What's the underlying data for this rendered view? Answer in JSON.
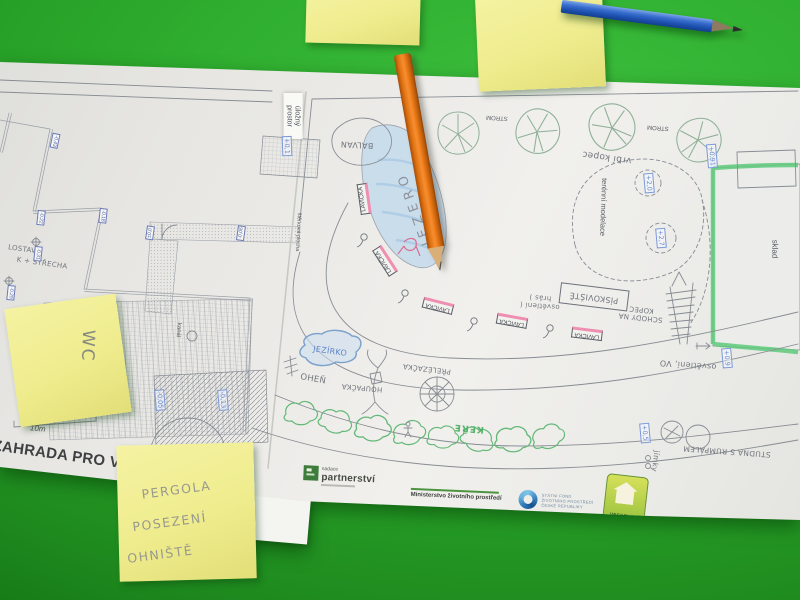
{
  "plan": {
    "title": "ZAHRADA PRO VŠEC",
    "scale": "10m",
    "labels": [
      {
        "text": "úložný prostor",
        "x": 293,
        "y": 116,
        "rot": 90,
        "cls": "tag",
        "fs": 7,
        "w": 40,
        "name": "label-ulozny-prostor"
      },
      {
        "text": "BALVAN",
        "x": 357,
        "y": 144,
        "rot": 183,
        "cls": "hand",
        "fs": 8,
        "name": "label-balvan"
      },
      {
        "text": "JEZERO",
        "x": 415,
        "y": 208,
        "rot": 250,
        "cls": "hand jez",
        "fs": 13,
        "name": "label-jezero"
      },
      {
        "text": "STROM",
        "x": 497,
        "y": 117,
        "rot": 183,
        "cls": "print",
        "fs": 6,
        "name": "label-strom"
      },
      {
        "text": "STROM",
        "x": 658,
        "y": 127,
        "rot": 184,
        "cls": "print",
        "fs": 6,
        "name": "label-strom"
      },
      {
        "text": "vrbí kopec",
        "x": 607,
        "y": 156,
        "rot": 188,
        "cls": "hand",
        "fs": 9,
        "name": "label-vrbi-kopec"
      },
      {
        "text": "terénní modelace",
        "x": 603,
        "y": 207,
        "rot": 92,
        "cls": "print",
        "fs": 7.5,
        "name": "label-terenni-modelace"
      },
      {
        "text": "sklad",
        "x": 774,
        "y": 249,
        "rot": 91,
        "cls": "print",
        "fs": 8,
        "name": "label-sklad"
      },
      {
        "text": "PÍSKOVIŠTĚ",
        "x": 594,
        "y": 297,
        "rot": 187,
        "cls": "hand box",
        "fs": 8,
        "name": "label-piskoviste"
      },
      {
        "text": "SCHODY NA KOPEC",
        "x": 641,
        "y": 313,
        "rot": 186,
        "cls": "hand",
        "fs": 7,
        "w": 46,
        "name": "label-schody-na-kopec"
      },
      {
        "text": "osvětlení ( hrás )",
        "x": 540,
        "y": 301,
        "rot": 184,
        "cls": "hand",
        "fs": 7,
        "w": 42,
        "name": "label-osvetleni"
      },
      {
        "text": "osvětlení, VO",
        "x": 688,
        "y": 364,
        "rot": 184,
        "cls": "hand",
        "fs": 8,
        "name": "label-osvetleni-vo"
      },
      {
        "text": "JEZÍRKO",
        "x": 330,
        "y": 352,
        "rot": 8,
        "cls": "hand blue",
        "fs": 8,
        "name": "label-jezirko"
      },
      {
        "text": "OHEŇ",
        "x": 313,
        "y": 380,
        "rot": 10,
        "cls": "hand",
        "fs": 8.5,
        "name": "label-ohen"
      },
      {
        "text": "HOUPAČKA",
        "x": 362,
        "y": 387,
        "rot": 185,
        "cls": "hand",
        "fs": 7,
        "name": "label-houpacka"
      },
      {
        "text": "PŘELÉZAČKA",
        "x": 427,
        "y": 368,
        "rot": 187,
        "cls": "hand",
        "fs": 7,
        "name": "label-prelezacka"
      },
      {
        "text": "KEŘE",
        "x": 469,
        "y": 427,
        "rot": 185,
        "cls": "hand green",
        "fs": 9,
        "name": "label-kere"
      },
      {
        "text": "STUDNA S RUMPÁLEM",
        "x": 727,
        "y": 451,
        "rot": 184,
        "cls": "hand",
        "fs": 7.5,
        "name": "label-studna"
      },
      {
        "text": "jímky",
        "x": 655,
        "y": 461,
        "rot": 97,
        "cls": "hand",
        "fs": 7.5,
        "name": "label-jimky"
      },
      {
        "text": "kanál",
        "x": 178,
        "y": 330,
        "rot": 95,
        "cls": "print",
        "fs": 6,
        "name": "label-kanal"
      },
      {
        "text": "bez",
        "x": 237,
        "y": 453,
        "rot": 95,
        "cls": "print",
        "fs": 6,
        "name": "label-bez"
      },
      {
        "text": "LOSTAV",
        "x": 22,
        "y": 250,
        "rot": 8,
        "cls": "hand",
        "fs": 7,
        "name": "label-lostav"
      },
      {
        "text": "K + STŘECHA",
        "x": 42,
        "y": 264,
        "rot": 8,
        "cls": "hand",
        "fs": 7,
        "name": "label-strecha"
      },
      {
        "text": "štěrková plocha",
        "x": 298,
        "y": 232,
        "rot": 93,
        "cls": "print",
        "fs": 5.5,
        "name": "label-sterkova-plocha"
      }
    ],
    "benches": {
      "label": "LAVIČKA",
      "positions": [
        {
          "x": 364,
          "y": 199,
          "rot": 262
        },
        {
          "x": 385,
          "y": 261,
          "rot": 237
        },
        {
          "x": 438,
          "y": 306,
          "rot": 194
        },
        {
          "x": 512,
          "y": 321,
          "rot": 190
        },
        {
          "x": 587,
          "y": 334,
          "rot": 187
        }
      ]
    },
    "elevation_markers": [
      {
        "t": "-0,43",
        "x": 55,
        "y": 141,
        "rot": 102,
        "c": "ink"
      },
      {
        "t": "-0,22",
        "x": 41,
        "y": 218,
        "rot": 96,
        "c": "ink"
      },
      {
        "t": "-0,18",
        "x": 103,
        "y": 216,
        "rot": 96,
        "c": "ink"
      },
      {
        "t": "-0,31",
        "x": 38,
        "y": 254,
        "rot": 96,
        "c": "ink"
      },
      {
        "t": "-0,29",
        "x": 11,
        "y": 293,
        "rot": 96,
        "c": "ink"
      },
      {
        "t": "±0,0",
        "x": 150,
        "y": 233,
        "rot": 278,
        "c": "ink"
      },
      {
        "t": "-0,06",
        "x": 241,
        "y": 233,
        "rot": 278,
        "c": "ink"
      },
      {
        "t": "-0,05",
        "x": 160,
        "y": 400,
        "rot": 85,
        "c": "blue"
      },
      {
        "t": "-0,13",
        "x": 223,
        "y": 400,
        "rot": 85,
        "c": "blue"
      },
      {
        "t": "+0,1",
        "x": 287,
        "y": 146,
        "rot": 88,
        "c": "blue"
      },
      {
        "t": "+2,0",
        "x": 649,
        "y": 183,
        "rot": 85,
        "c": "blue"
      },
      {
        "t": "+2,7",
        "x": 661,
        "y": 238,
        "rot": 85,
        "c": "blue"
      },
      {
        "t": "+0,91",
        "x": 712,
        "y": 156,
        "rot": 85,
        "c": "blue"
      },
      {
        "t": "+0,9",
        "x": 727,
        "y": 358,
        "rot": 85,
        "c": "blue"
      },
      {
        "t": "+0,5",
        "x": 645,
        "y": 433,
        "rot": 85,
        "c": "blue"
      }
    ]
  },
  "logos": {
    "partnerstvi": {
      "top": "nadace",
      "name": "partnerství"
    },
    "ministry": "Ministerstvo životního prostředí",
    "fund": [
      "STÁTNÍ FOND",
      "ŽIVOTNÍHO PROSTŘEDÍ",
      "ČESKÉ REPUBLIKY"
    ],
    "vespolek": "VESPOLEK"
  },
  "sticky_notes": [
    {
      "note": "blank-top-center"
    },
    {
      "note": "blank-top-right"
    },
    {
      "text": "WC"
    },
    {
      "lines": [
        "PERGOLA",
        "POSEZENÍ",
        "OHNIŠTĚ"
      ]
    }
  ],
  "pencils": [
    {
      "name": "orange pencil",
      "hex": "#e87a1f"
    },
    {
      "name": "blue pencil",
      "hex": "#2a5fc0"
    }
  ],
  "colors": {
    "table_green": "#2ca62c",
    "paper": "#ebeae6",
    "sticky_yellow": "#f0ed95",
    "crayon_green": "#5ec97b",
    "crayon_pink": "#ee8fb2",
    "pond_blue": "#b9d3e8"
  }
}
